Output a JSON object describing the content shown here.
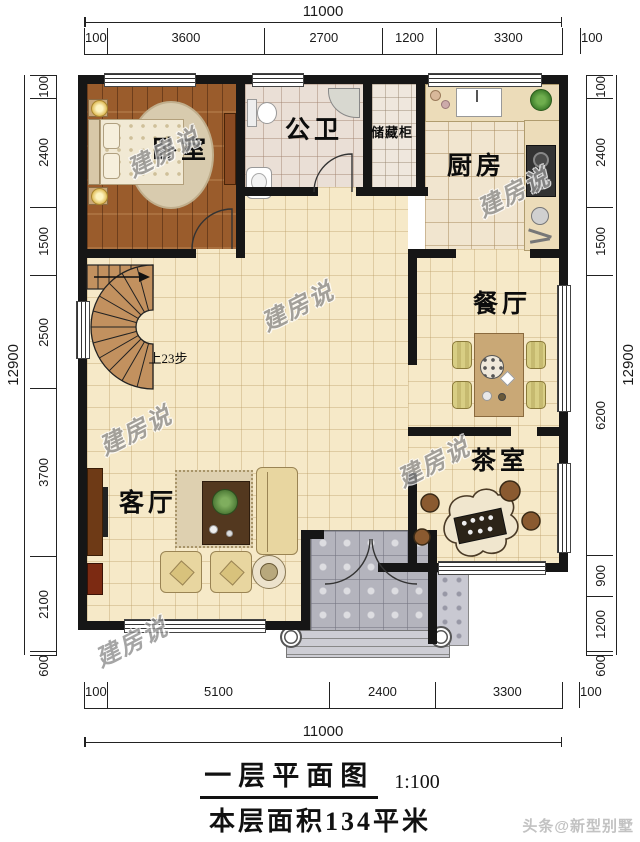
{
  "title": {
    "name": "一层平面图",
    "scale": "1:100",
    "area": "本层面积134平米"
  },
  "credit": "头条@新型别墅",
  "watermark": "建房说",
  "stair_note": "上23步",
  "rooms": {
    "bedroom": "卧室",
    "bathroom": "公卫",
    "storage": "储藏柜",
    "kitchen": "厨房",
    "dining": "餐厅",
    "tea": "茶室",
    "living": "客厅"
  },
  "dims": {
    "top": {
      "total": "11000",
      "segments": [
        "100",
        "3600",
        "2700",
        "1200",
        "3300",
        "100"
      ]
    },
    "bottom": {
      "total": "11000",
      "segments": [
        "100",
        "5100",
        "2400",
        "3300",
        "100"
      ]
    },
    "left": {
      "total": "12900",
      "segments": [
        "100",
        "2400",
        "1500",
        "2500",
        "3700",
        "2100",
        "600"
      ]
    },
    "right": {
      "total": "12900",
      "segments": [
        "100",
        "2400",
        "1500",
        "6200",
        "900",
        "1200",
        "600"
      ]
    }
  },
  "colors": {
    "wall": "#161616",
    "floor": "#f6e9c8",
    "wood": "#9a5c2c",
    "porch": "#b4b4bd"
  }
}
